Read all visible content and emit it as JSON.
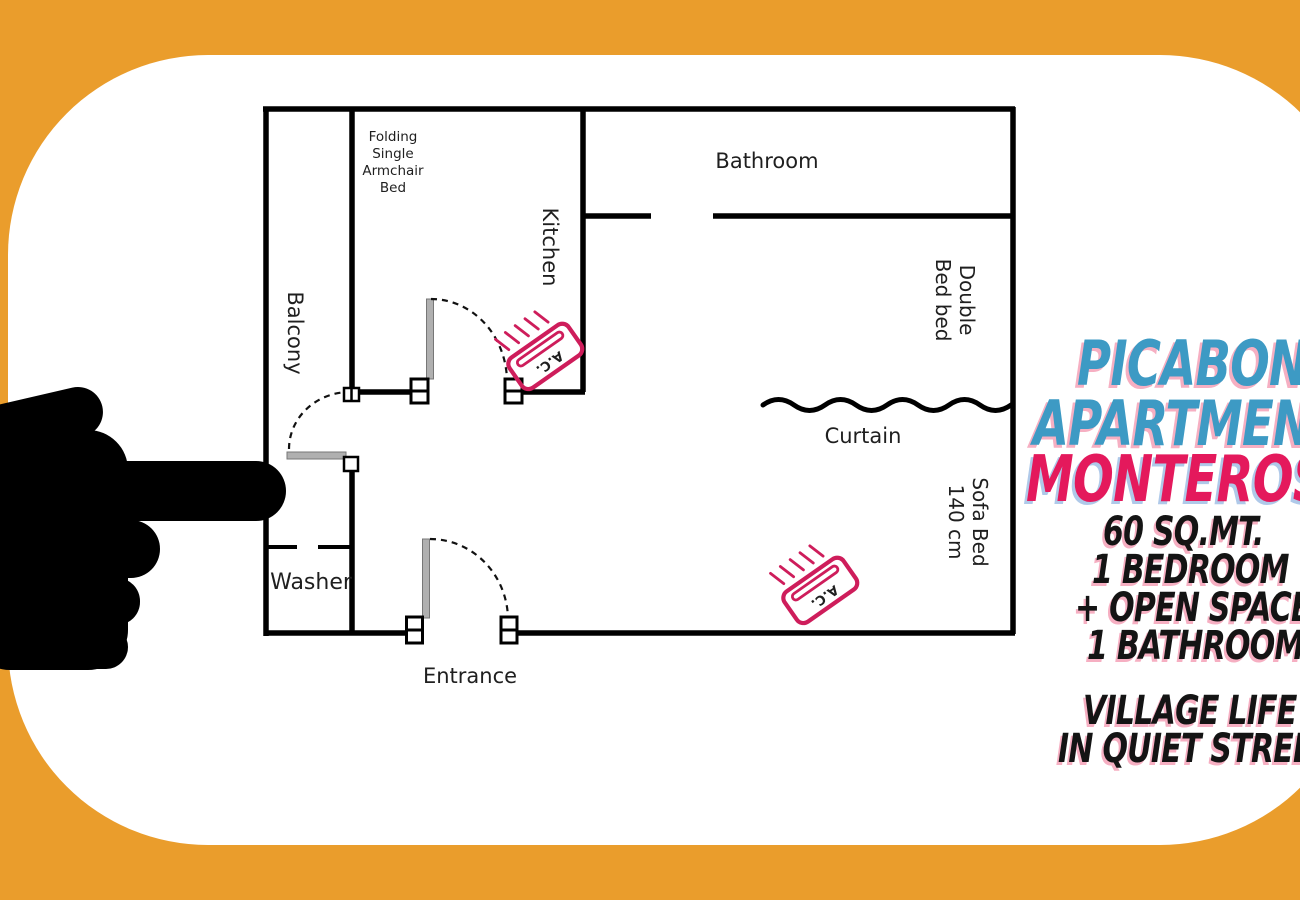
{
  "palette": {
    "background_orange": "#EA9D2C",
    "card_white": "#FFFFFF",
    "title_blue": "#3D9AC4",
    "title_pink": "#E4195C",
    "shadow_pink": "#F6AFC2",
    "shadow_blue": "#AFC9E9",
    "ac_icon_pink": "#CE1D5B",
    "wall_black": "#000000",
    "hand_black": "#000000"
  },
  "title": {
    "line1": "PICABONE",
    "line2": "APARTMENT",
    "line3": "MONTEROSSO"
  },
  "details": {
    "area": "60 SQ.MT.",
    "bedroom": "1 BEDROOM",
    "open_space": "+ OPEN SPACE",
    "bathroom": "1 BATHROOM"
  },
  "tagline": {
    "line1": "VILLAGE LIFE",
    "line2": "IN QUIET STREET"
  },
  "floorplan": {
    "labels": {
      "bathroom": "Bathroom",
      "kitchen": "Kitchen",
      "balcony": "Balcony",
      "washer": "Washer",
      "entrance": "Entrance",
      "curtain": "Curtain",
      "folding_bed": [
        "Folding",
        "Single",
        "Armchair",
        "Bed"
      ],
      "double_bed": [
        "Double",
        "Bed bed"
      ],
      "sofa_bed": [
        "Sofa Bed",
        "140 cm"
      ],
      "ac": "A.C."
    }
  }
}
